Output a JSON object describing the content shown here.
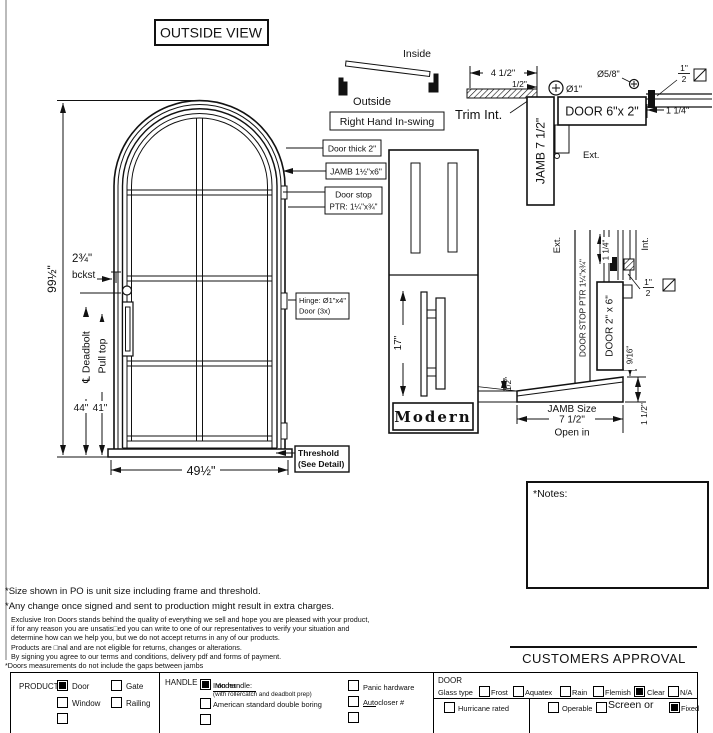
{
  "page": {
    "title": "OUTSIDE VIEW"
  },
  "swing": {
    "inside": "Inside",
    "outside": "Outside",
    "label": "Right Hand In-swing"
  },
  "elevation": {
    "height_dim": "99½\"",
    "width_dim": "49½\"",
    "backset_num": "2¾\"",
    "backset_label": "bckst",
    "deadbolt_label": "℄ Deadbolt",
    "deadbolt_dim": "44\"",
    "pull_label": "Pull top",
    "pull_dim": "41\"",
    "door_thick": "Door thick 2\"",
    "jamb": "JAMB  1½\"x6\"",
    "door_stop_line1": "Door stop",
    "door_stop_line2": "PTR: 1¼\"x¾\"",
    "hinge_line1": "Hinge: Ø1\"x4\"",
    "hinge_line2": "Door (3x)",
    "threshold_line1": "Threshold",
    "threshold_line2": "(See Detail)"
  },
  "head_detail": {
    "dim_width": "4 1/2\"",
    "dim_trim": "1/2\"",
    "trim_label": "Trim Int.",
    "jamb_label": "JAMB 7 1/2\"",
    "hinge_dia": "Ø1\"",
    "bolt_dia": "Ø5/8\"",
    "door_label": "DOOR 6\"x 2\"",
    "frac_num": "1\"",
    "frac_den": "2",
    "dim_gap": "1 1/4\"",
    "ext_label": "Ext."
  },
  "jamb_section": {
    "ext_label": "Ext.",
    "int_label": "Int.",
    "door_stop_label": "DOOR STOP PTR 1¼\"x¾\"",
    "door_label": "DOOR 2\" x 6\"",
    "dim_gap": "1 1/4\"",
    "frac_num": "1\"",
    "frac_den": "2",
    "dim_916": "9/16\"",
    "dim_half": "1/2\"",
    "jamb_size_line1": "JAMB Size",
    "jamb_size_line2": "7 1/2\"",
    "jamb_size_line3": "Open in",
    "dim_15": "1 1/2\""
  },
  "handle_panel": {
    "dim": "17\"",
    "name": "Modern"
  },
  "notes_label": "*Notes:",
  "footnotes": {
    "line1": "*Size shown in PO is unit size including frame and threshold.",
    "line2": "*Any change once signed and sent to production might result in extra charges.",
    "small1": "Exclusive Iron Doors stands behind the quality of everything we sell and hope you are pleased with your product,",
    "small2": "if for any reason you are unsatis□ed you can write to one of our representatives to verify your situation and",
    "small3": "determine how can we help you, but we do not accept returns in any of our products.",
    "small4": "Products are □nal and are not eligible for returns, changes or alterations.",
    "small5": "By signing you agree to our terms and conditions, delivery pdf and forms of payment.",
    "small6": "*Doors measurements do not include the gaps between jambs"
  },
  "approval_label": "CUSTOMERS APPROVAL",
  "form": {
    "product": {
      "label": "PRODUCT:",
      "options": [
        {
          "label": "Door",
          "checked": true
        },
        {
          "label": "Gate",
          "checked": false
        },
        {
          "label": "Window",
          "checked": false
        },
        {
          "label": "Railing",
          "checked": false
        }
      ]
    },
    "handle": {
      "label": "HANDLE",
      "iron_label": "Iron handle:",
      "iron_value": "Modern",
      "iron_checked": true,
      "iron_note": "(with rollercatch and deadbolt prep)",
      "option2": "American standard double boring",
      "option3": "Panic hardware",
      "option4": "Autocloser #"
    },
    "door": {
      "label": "DOOR",
      "glass_label": "Glass type",
      "glass_options": [
        {
          "label": "Frost",
          "checked": false
        },
        {
          "label": "Aquatex",
          "checked": false
        },
        {
          "label": "Rain",
          "checked": false
        },
        {
          "label": "Flemish",
          "checked": false
        },
        {
          "label": "Clear",
          "checked": true
        },
        {
          "label": "N/A",
          "checked": false
        }
      ],
      "hurricane": "Hurricane rated",
      "operable": "Operable",
      "screen": "Screen or",
      "fixed": "Fixed"
    }
  }
}
